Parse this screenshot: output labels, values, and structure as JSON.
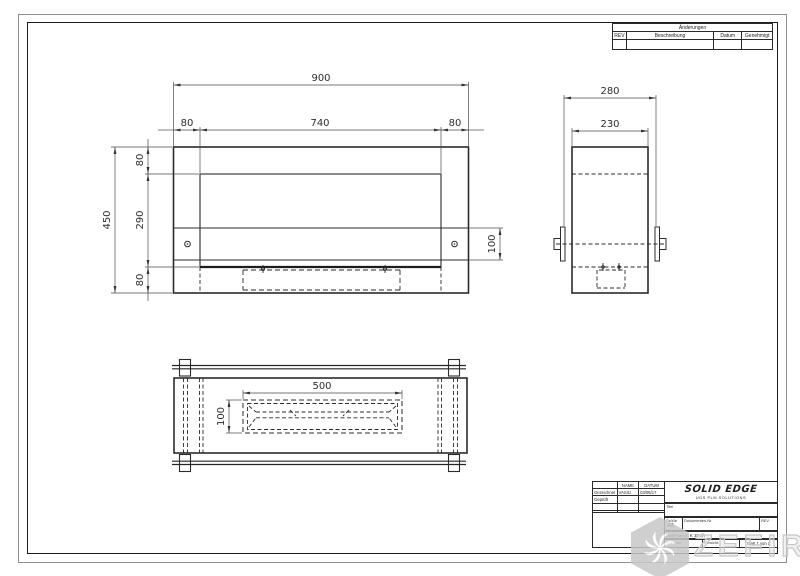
{
  "revision_table": {
    "title": "Änderungen",
    "col_rev": "REV",
    "col_desc": "Beschreibung",
    "col_date": "Datum",
    "col_approved": "Genehmigt"
  },
  "title_block": {
    "name_header": "NAME",
    "date_header": "DATUM",
    "rows": [
      {
        "label": "Gezeichnet",
        "name": "VASILI",
        "date": "03/05/17"
      },
      {
        "label": "Geprüft",
        "name": "",
        "date": ""
      },
      {
        "label": "",
        "name": "",
        "date": ""
      },
      {
        "label": "",
        "name": "",
        "date": ""
      }
    ],
    "logo_title": "SOLID EDGE",
    "logo_subtitle": "UGS PLM SOLUTIONS",
    "title_label": "Titel",
    "title_value": "",
    "size_label": "Größe",
    "size_value": "A2",
    "doc_label": "Dokumenten-Nr",
    "rev_label": "REV",
    "file_label": "Dateiname:",
    "file_value": "K 13.dft",
    "scale_label": "Maßstab:",
    "weight_label": "Gewicht:",
    "sheet_label": "Blatt 1 von 1"
  },
  "watermark": {
    "text": "ZEFIRE"
  },
  "dimensions": {
    "front_overall_width": "900",
    "front_left_offset": "80",
    "front_opening_width": "740",
    "front_right_offset": "80",
    "front_overall_height": "450",
    "front_top_offset": "80",
    "front_opening_height": "290",
    "front_bottom_offset": "80",
    "front_strip_height": "100",
    "side_overall_depth": "280",
    "side_body_depth": "230",
    "bottom_burner_length": "500",
    "bottom_burner_width": "100"
  }
}
